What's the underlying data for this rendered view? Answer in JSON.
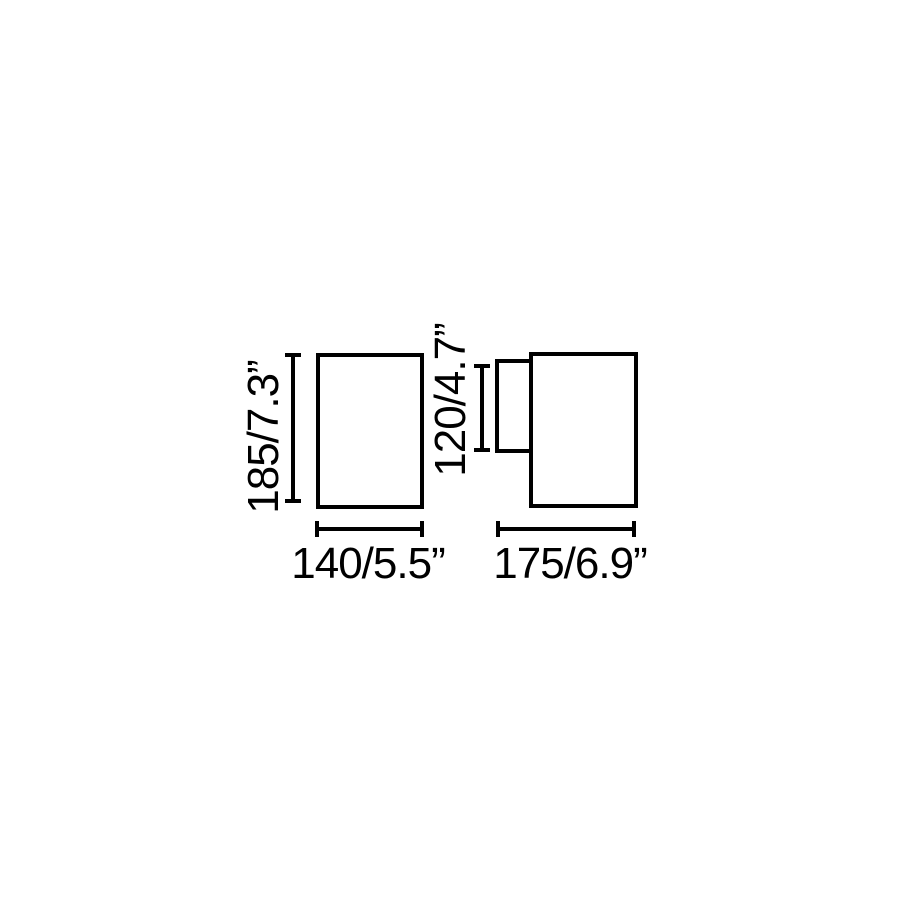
{
  "canvas": {
    "background": "#ffffff",
    "line_color": "#000000"
  },
  "drawing": {
    "front_view": {
      "height_label": "185/7.3”",
      "height_mm": 185,
      "height_in": 7.3,
      "width_label": "140/5.5”",
      "width_mm": 140,
      "width_in": 5.5
    },
    "side_view": {
      "body_height_label": "120/4.7”",
      "body_height_mm": 120,
      "body_height_in": 4.7,
      "depth_label": "175/6.9”",
      "depth_mm": 175,
      "depth_in": 6.9
    }
  }
}
